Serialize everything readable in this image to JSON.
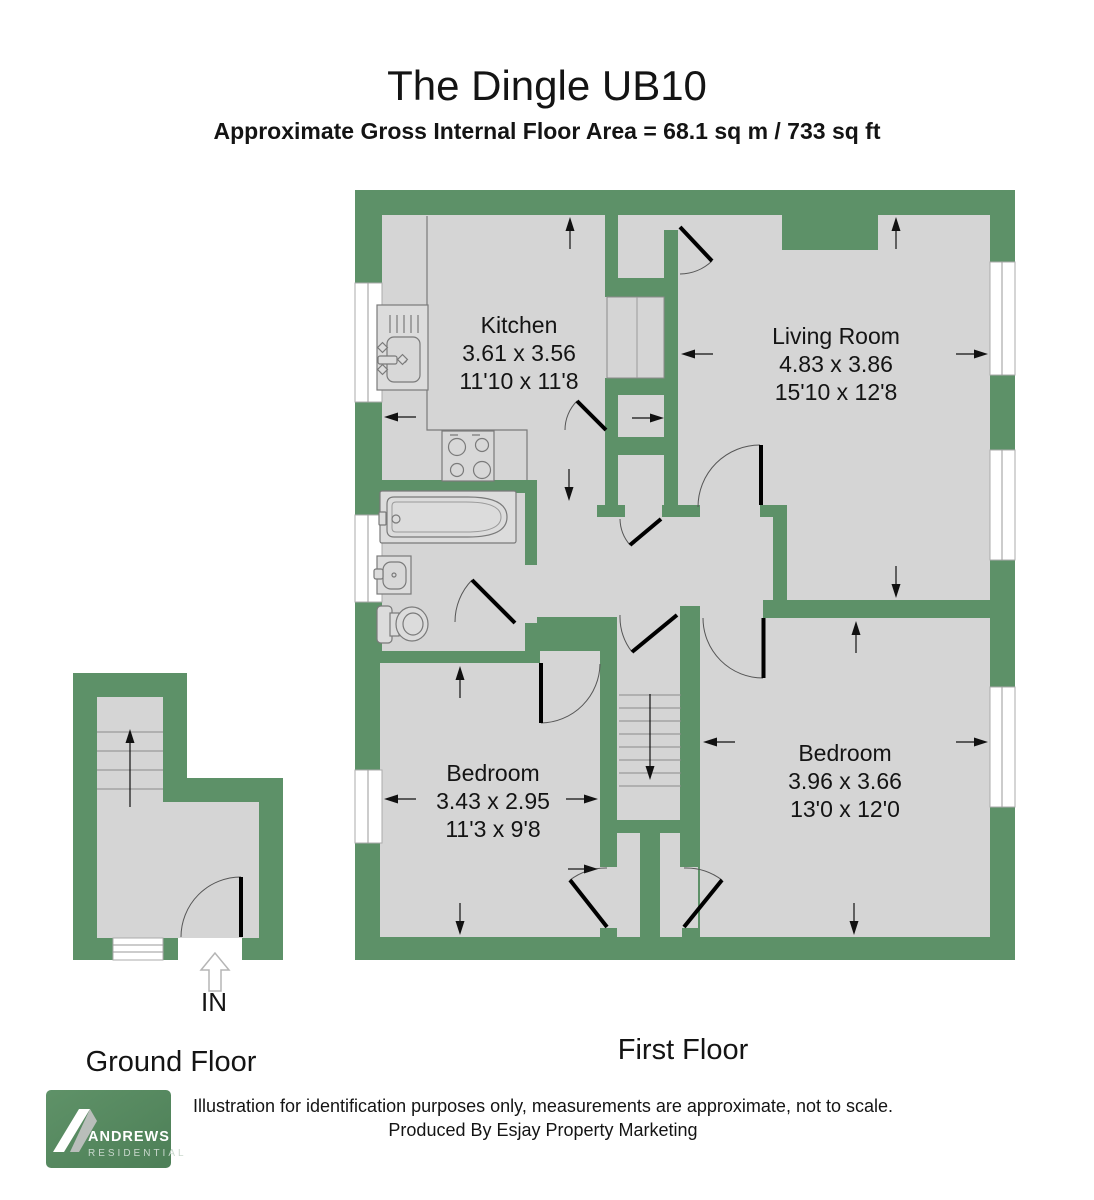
{
  "title": "The Dingle UB10",
  "subtitle": "Approximate Gross Internal Floor Area = 68.1 sq m / 733 sq ft",
  "floors": {
    "first": {
      "label": "First Floor"
    },
    "ground": {
      "label": "Ground Floor",
      "entrance": "IN"
    }
  },
  "rooms": [
    {
      "name": "Kitchen",
      "metric": "3.61 x 3.56",
      "imperial": "11'10 x 11'8"
    },
    {
      "name": "Living Room",
      "metric": "4.83 x 3.86",
      "imperial": "15'10 x 12'8"
    },
    {
      "name": "Bedroom",
      "metric": "3.43 x 2.95",
      "imperial": "11'3 x 9'8"
    },
    {
      "name": "Bedroom",
      "metric": "3.96 x 3.66",
      "imperial": "13'0 x 12'0"
    }
  ],
  "footer": {
    "disclaimer_line1": "Illustration for identification purposes only, measurements are approximate, not to scale.",
    "disclaimer_line2": "Produced By Esjay Property Marketing"
  },
  "logo": {
    "brand": "ANDREWS",
    "division": "RESIDENTIAL"
  },
  "colors": {
    "wall": "#5d9168",
    "floor": "#d5d5d5",
    "logo": "#54855d"
  }
}
